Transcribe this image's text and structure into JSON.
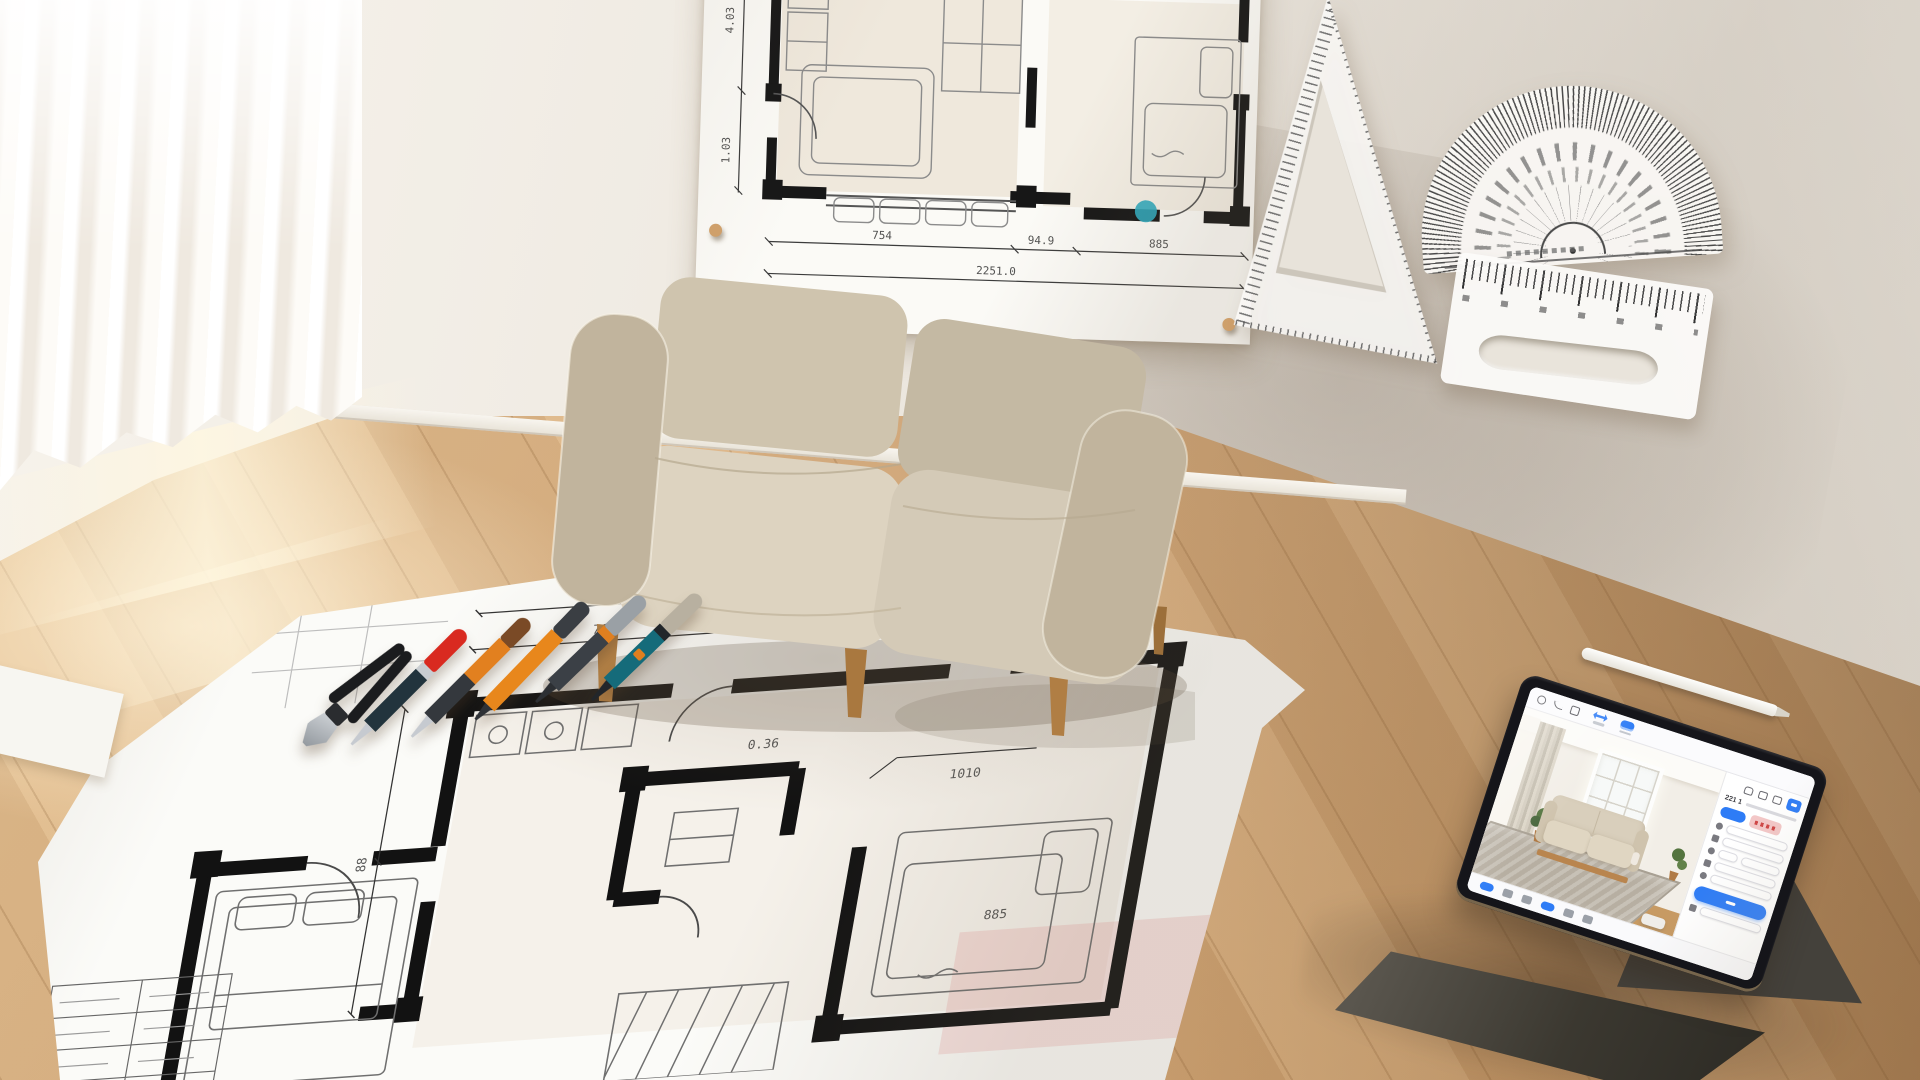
{
  "scene": {
    "description": "Sunlit interior-design workspace: beige fabric sofa against a white wall, hand-drawn architectural floor plans pinned to the wall and spread on the wooden floor, drafting tools (set square, protractor, ruler), pens and pliers, and a tablet on a folio stand running an interior design app",
    "wall_color": "#ece7df",
    "floor_wood_color": "#d9b184",
    "baseboard_color": "#f6f3ec"
  },
  "wall_plan": {
    "paper_color": "#fbfaf6",
    "accent_dot_color": "#2fa9bd",
    "pin_color": "#cfa06b",
    "dims_bottom": [
      "754",
      "94.9",
      "885"
    ],
    "dim_total": "2251.0",
    "dims_side": [
      "4.03",
      "1.03"
    ]
  },
  "floor_plan": {
    "paper_color": "#fbfbf8",
    "dims_top": [
      "707",
      "949",
      "403"
    ],
    "dim_total": "2251.0",
    "dim_left": "88",
    "dims_misc": [
      "0.36",
      "1010",
      "885"
    ],
    "highlight_color": "rgba(231,148,148,0.25)"
  },
  "tools": {
    "pliers": {
      "name": "wire-pliers",
      "handles": "#1b1c1e",
      "jaw_light": "#ccd0d4",
      "jaw_dark": "#8e949a"
    },
    "pens": [
      {
        "name": "red-cap-pen",
        "cap": "#d92a20",
        "band": "#c9cdd1",
        "body": "#22343d",
        "tip": "#c6cad0"
      },
      {
        "name": "copper-pen",
        "cap": "#7a4a26",
        "band": "#e2801f",
        "body": "#34383d",
        "tip": "#c6cad0"
      },
      {
        "name": "orange-marker",
        "cap": "#3a3e43",
        "band": "#e8871c",
        "body": "#e8871c",
        "tip": "#2e3136"
      },
      {
        "name": "gray-clip-pen",
        "cap": "#9aa0a5",
        "band": "#e07f1f",
        "body": "#3b4046",
        "tip": "#2c2f33"
      },
      {
        "name": "teal-pen",
        "cap": "#b8b0a0",
        "band": "#22262a",
        "body": "#156b7a",
        "tip": "#22262a"
      }
    ]
  },
  "sofa": {
    "fabric_light": "#ddd3c0",
    "fabric_mid": "#cfc4ae",
    "fabric_dark": "#c1b49d",
    "wood": "#c28e52"
  },
  "tablet": {
    "bezel_color": "#15151a",
    "case_color": "#44413b",
    "accent_blue": "#2e7cf6",
    "panel": {
      "header": "221 1",
      "chip_primary_color": "#2e7cf6",
      "chip_danger_color": "#f3c7c7",
      "field_rows": 6
    },
    "top_toolbar_icons": [
      "back-icon",
      "undo-icon",
      "crop-icon",
      "measure-icon",
      "save-icon"
    ],
    "panel_toolbar_icons": [
      "camera-icon",
      "cube-icon",
      "gallery-icon",
      "share-icon"
    ],
    "bottom_toolbar_icons": [
      "move-icon",
      "grid-icon",
      "furniture-icon",
      "camera-icon",
      "layers-icon",
      "settings-icon"
    ],
    "canvas": {
      "wall": "#f2eee7",
      "rug": "#b7afa2",
      "sofa_fabric": "#d9cfbc",
      "wood_floor": "#c79a63",
      "plant": "#54743f"
    }
  }
}
